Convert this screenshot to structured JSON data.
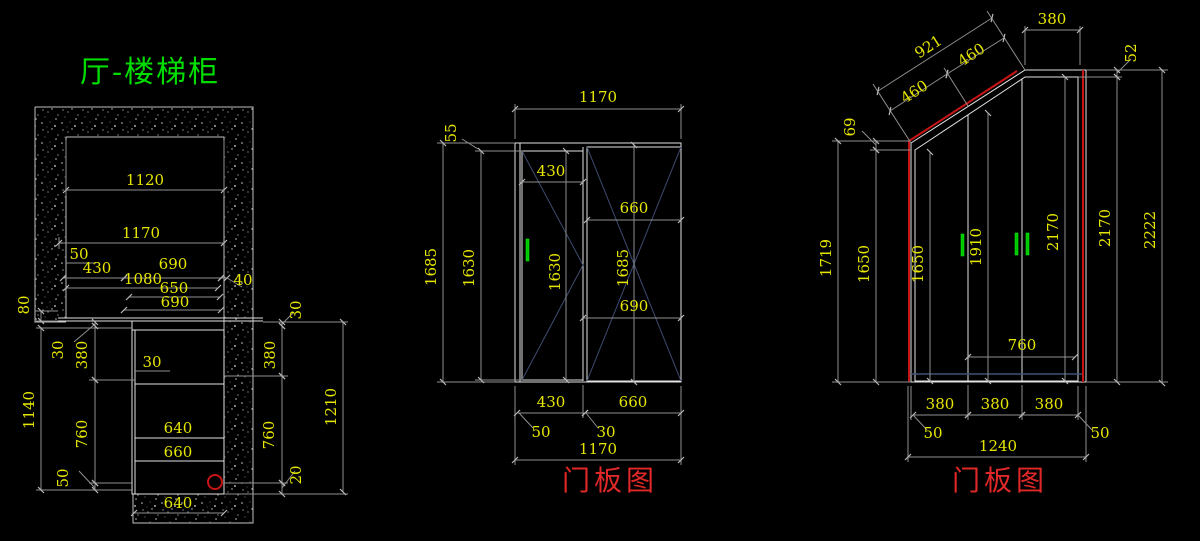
{
  "title": {
    "text": "厅-楼梯柜"
  },
  "colors": {
    "background": "#000000",
    "object_line": "#e2e2e2",
    "dimension_line": "#8f8f8f",
    "dimension_text": "#e6e600",
    "title_green": "#00dd00",
    "label_red": "#e02828",
    "accent_red_line": "#c81414",
    "handle_green": "#00c400",
    "door_diagonal_blue": "#3e4c70"
  },
  "plan": {
    "dims": {
      "w1120": "1120",
      "w1170": "1170",
      "o50": "50",
      "w430": "430",
      "w1080": "1080",
      "w690a": "690",
      "o40": "40",
      "w650": "650",
      "w690b": "690",
      "l80": "80",
      "l30": "30",
      "l380": "380",
      "l1140": "1140",
      "l760": "760",
      "l50": "50",
      "r30": "30",
      "r380": "380",
      "r760": "760",
      "r20": "20",
      "r1210": "1210",
      "c30": "30",
      "c640": "640",
      "c660": "660",
      "b640": "640"
    }
  },
  "door1": {
    "label": "门板图",
    "dims": {
      "top1170": "1170",
      "t55": "55",
      "h1685": "1685",
      "h1630": "1630",
      "w430": "430",
      "dh1630": "1630",
      "w660": "660",
      "dh1685": "1685",
      "w690": "690",
      "b430": "430",
      "b660": "660",
      "b50": "50",
      "b30": "30",
      "b1170": "1170"
    }
  },
  "door2": {
    "label": "门板图",
    "dims": {
      "s921": "921",
      "s460a": "460",
      "s460b": "460",
      "t380": "380",
      "t52": "52",
      "l69": "69",
      "l1719": "1719",
      "l1650": "1650",
      "il1650": "1650",
      "i1910": "1910",
      "i2170": "2170",
      "r2170": "2170",
      "r2222": "2222",
      "m760": "760",
      "b380a": "380",
      "b380b": "380",
      "b380c": "380",
      "b50l": "50",
      "b50r": "50",
      "b1240": "1240"
    }
  }
}
